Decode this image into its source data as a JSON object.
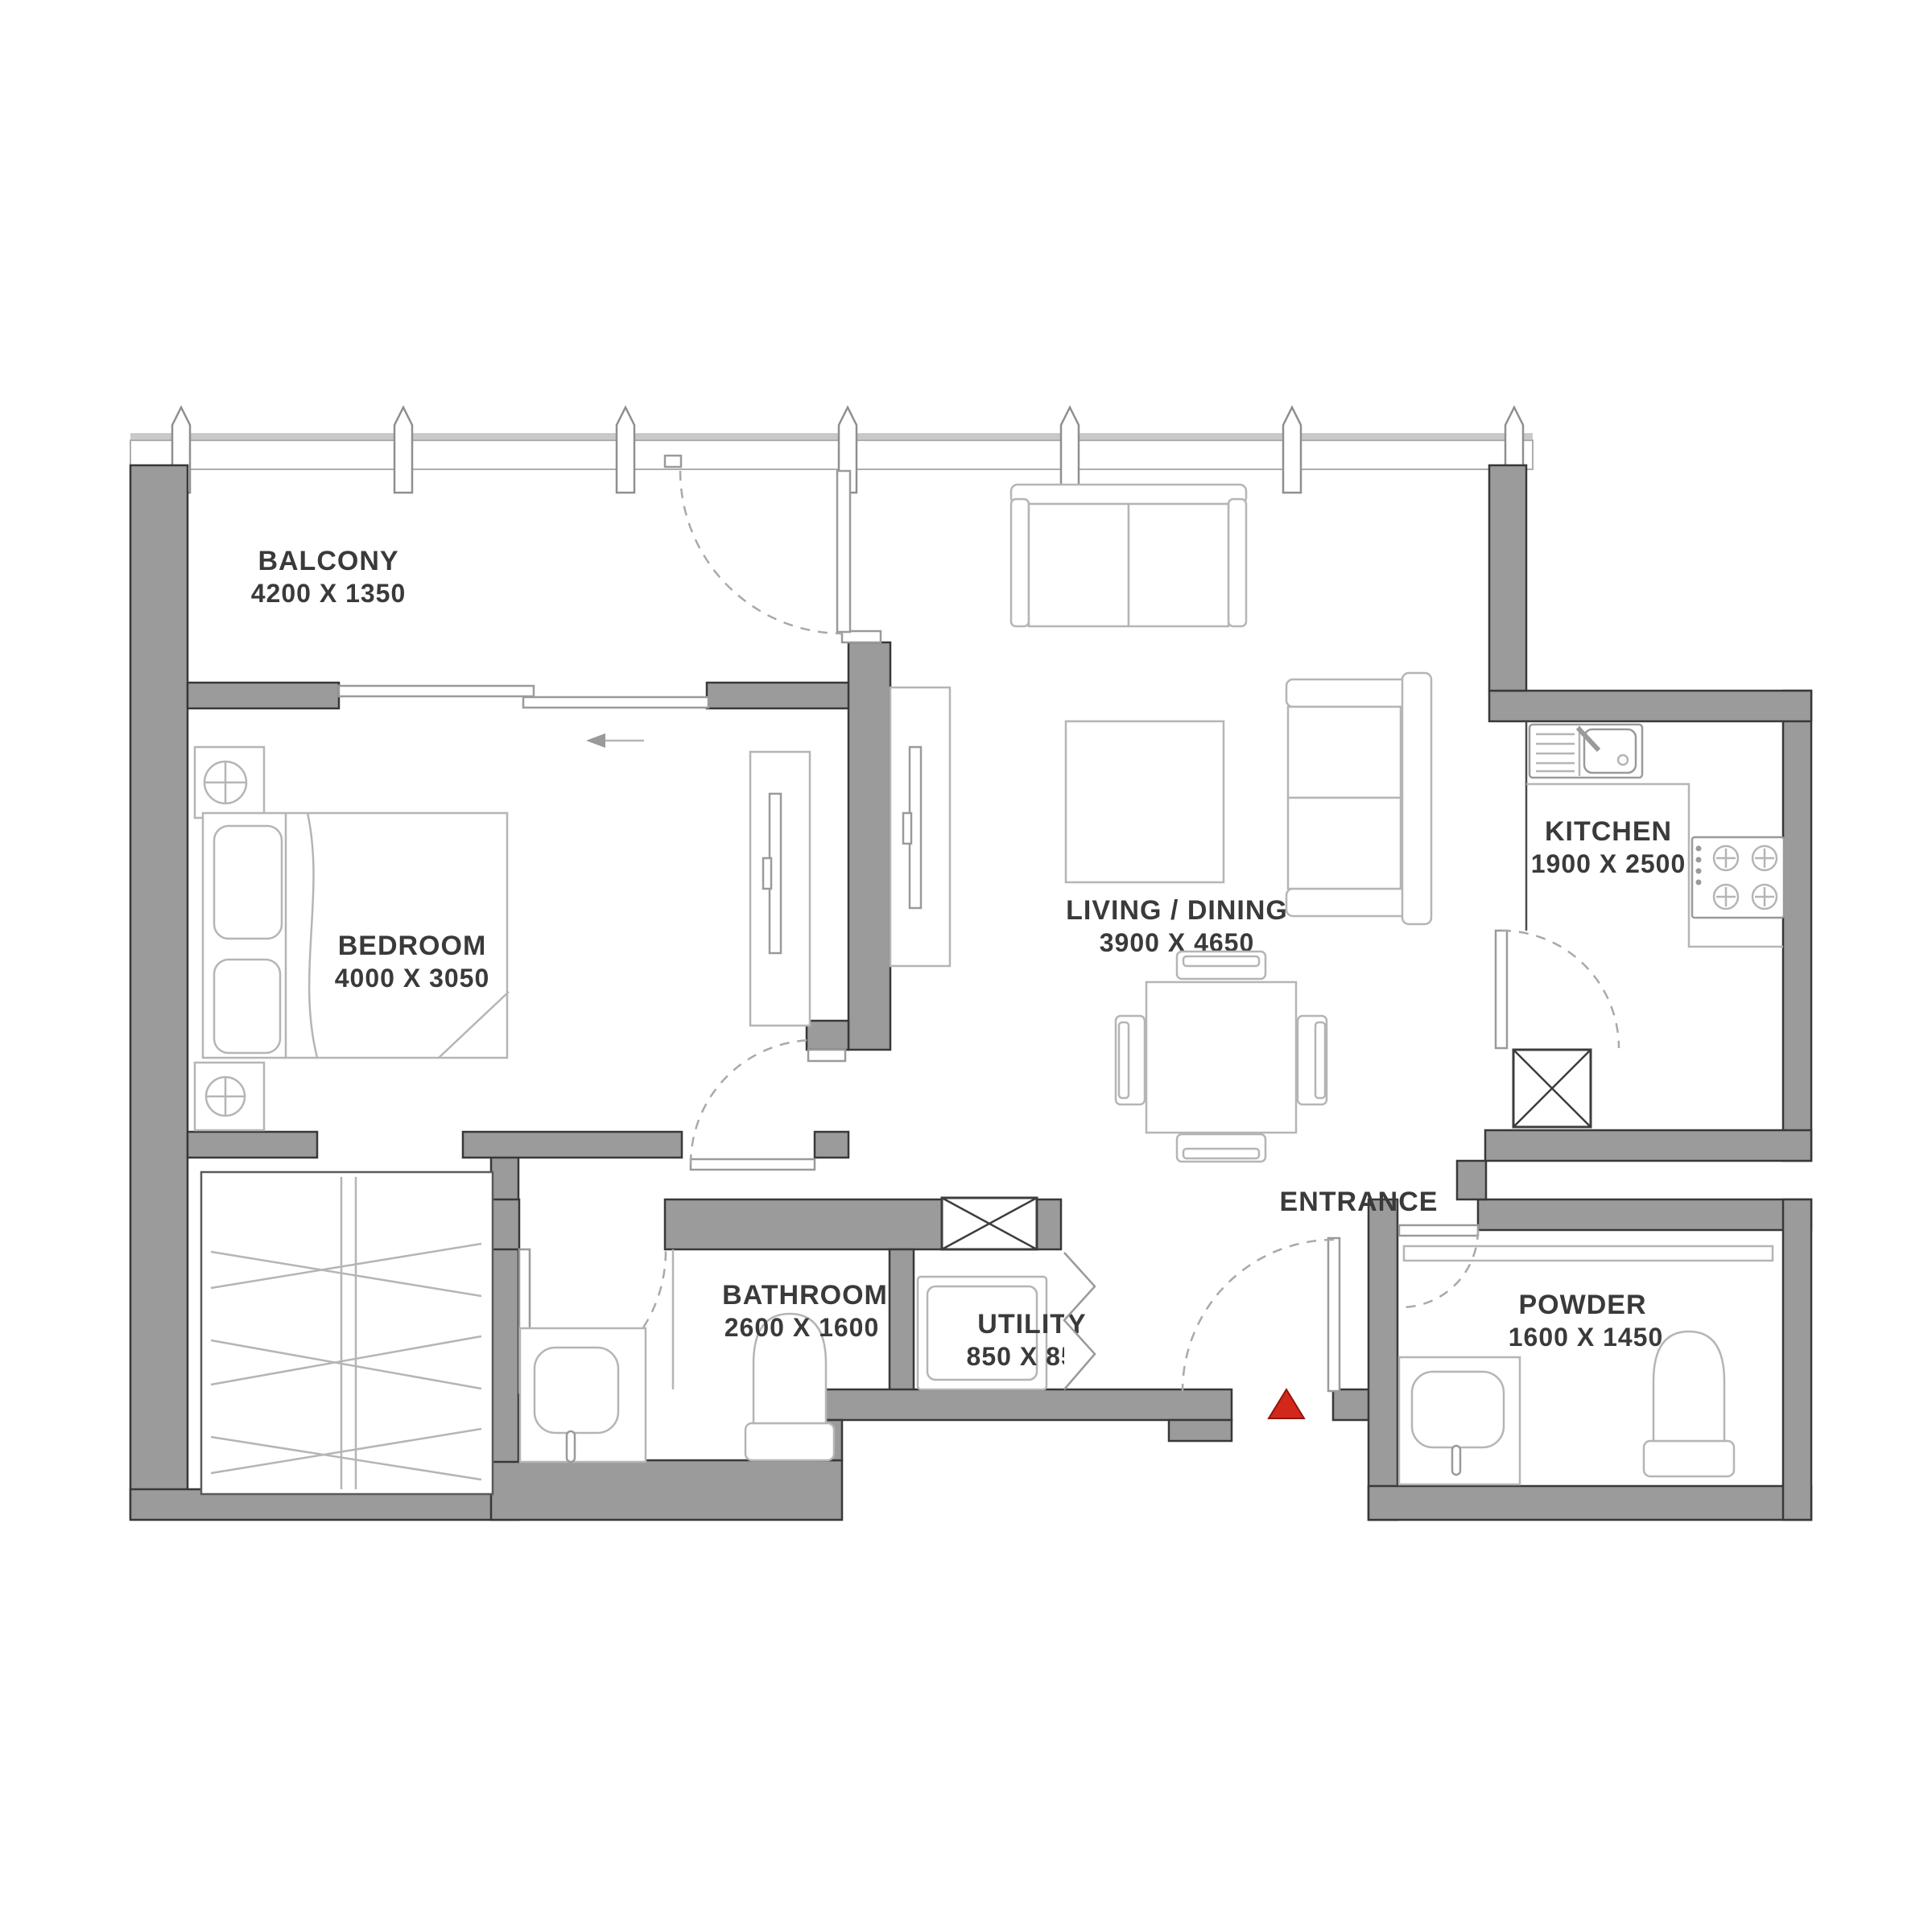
{
  "plan": {
    "type": "apartment-floor-plan",
    "rooms": [
      {
        "id": "balcony",
        "name": "BALCONY",
        "dimensions": "4200 X 1350"
      },
      {
        "id": "bedroom",
        "name": "BEDROOM",
        "dimensions": "4000 X 3050"
      },
      {
        "id": "living-dining",
        "name": "LIVING / DINING",
        "dimensions": "3900 X 4650"
      },
      {
        "id": "kitchen",
        "name": "KITCHEN",
        "dimensions": "1900 X 2500"
      },
      {
        "id": "bathroom",
        "name": "BATHROOM",
        "dimensions": "2600 X 1600"
      },
      {
        "id": "utility",
        "name": "UTILITY",
        "dimensions": "850 X 850"
      },
      {
        "id": "powder",
        "name": "POWDER",
        "dimensions": "1600 X 1450"
      },
      {
        "id": "entrance",
        "name": "ENTRANCE",
        "dimensions": ""
      }
    ],
    "colors": {
      "wall_fill": "#9b9b9b",
      "wall_edge": "#383838",
      "furniture_line": "#b5b5b5",
      "label_text": "#3a3a3a",
      "entrance_marker": "#d3271c",
      "background": "#ffffff"
    }
  }
}
